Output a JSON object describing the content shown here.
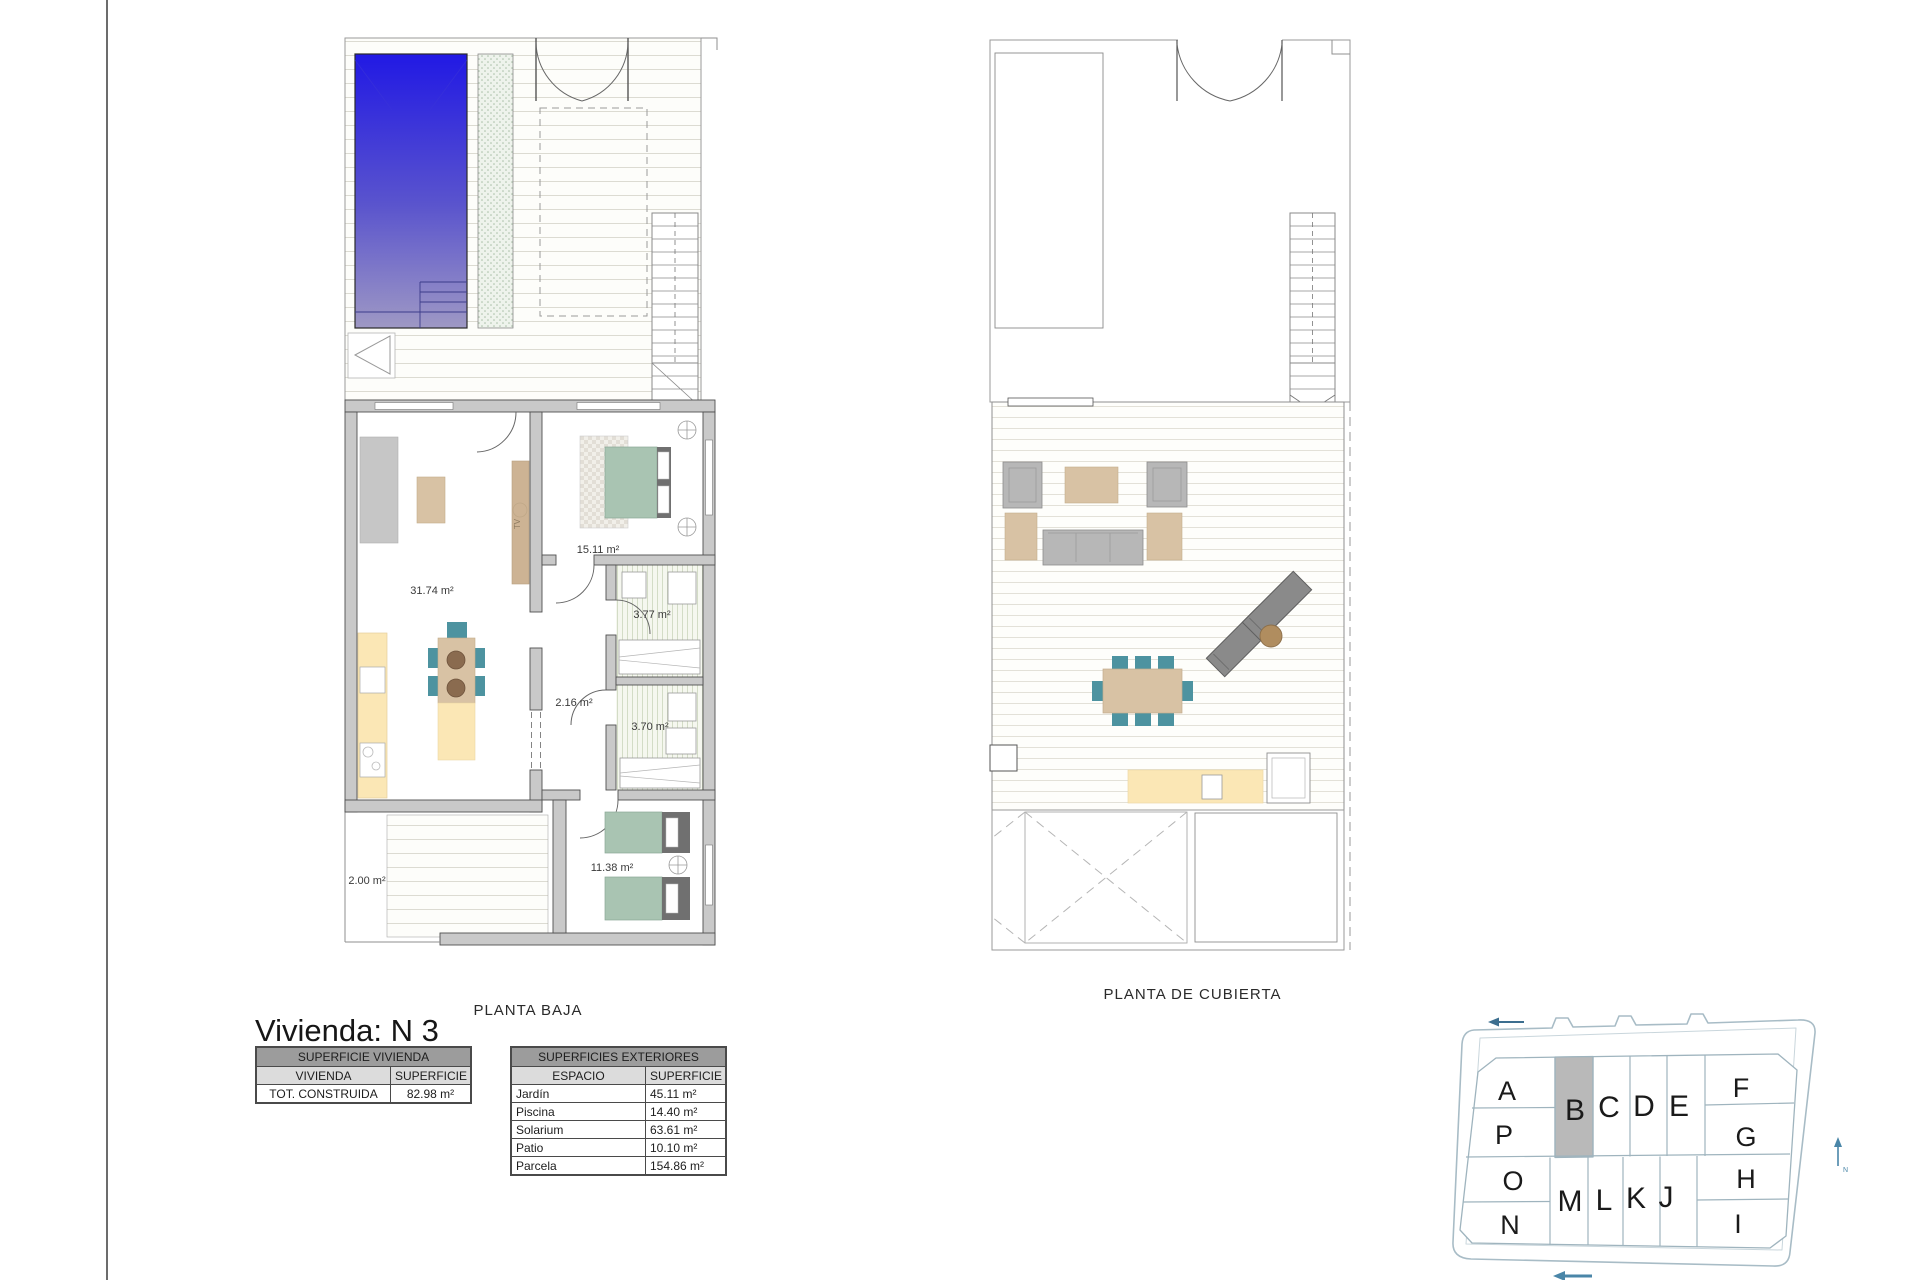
{
  "page": {
    "title": "Vivienda: N 3"
  },
  "plans": {
    "planta_baja": {
      "caption": "PLANTA BAJA",
      "tv_label": "TV",
      "rooms": [
        {
          "name": "salon-cocina",
          "area": "31.74 m²"
        },
        {
          "name": "dormitorio-principal",
          "area": "15.11 m²"
        },
        {
          "name": "bano-1",
          "area": "3.77 m²"
        },
        {
          "name": "distribuidor",
          "area": "2.16 m²"
        },
        {
          "name": "bano-2",
          "area": "3.70 m²"
        },
        {
          "name": "dormitorio-2",
          "area": "11.38 m²"
        },
        {
          "name": "patio",
          "area": "2.00 m²"
        }
      ]
    },
    "planta_cubierta": {
      "caption": "PLANTA DE CUBIERTA"
    }
  },
  "tables": {
    "vivienda": {
      "title": "SUPERFICIE VIVIENDA",
      "columns": [
        "VIVIENDA",
        "SUPERFICIE"
      ],
      "rows": [
        [
          "TOT. CONSTRUIDA",
          "82.98 m²"
        ]
      ]
    },
    "exteriores": {
      "title": "SUPERFICIES EXTERIORES",
      "columns": [
        "ESPACIO",
        "SUPERFICIE"
      ],
      "rows": [
        [
          "Jardín",
          "45.11 m²"
        ],
        [
          "Piscina",
          "14.40 m²"
        ],
        [
          "Solarium",
          "63.61 m²"
        ],
        [
          "Patio",
          "10.10 m²"
        ],
        [
          "Parcela",
          "154.86 m²"
        ]
      ]
    }
  },
  "site_plan": {
    "highlighted_plot": "B",
    "plots": [
      "A",
      "B",
      "C",
      "D",
      "E",
      "F",
      "G",
      "H",
      "I",
      "J",
      "K",
      "L",
      "M",
      "N",
      "O",
      "P"
    ]
  },
  "colors": {
    "pool_blue": "#2119e4",
    "chair_teal": "#4d93a0",
    "bed_sage": "#a9c4b2",
    "wood_beige": "#d8c2a4",
    "counter_yellow": "#fbe7b5",
    "highlight_gray": "#b9b9b9",
    "table_header_gray": "#9c9c9c"
  }
}
